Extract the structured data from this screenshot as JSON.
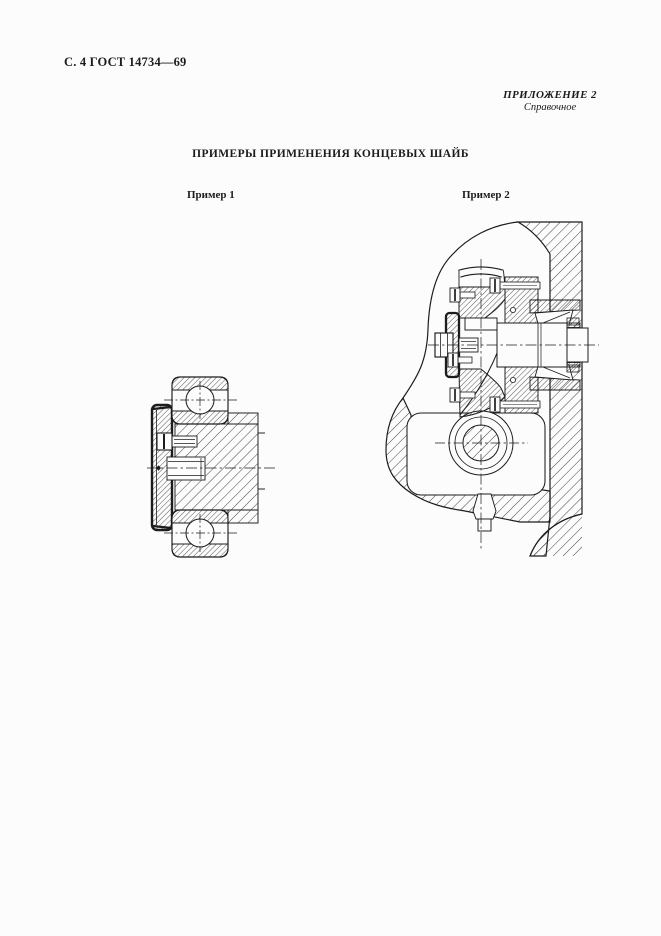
{
  "document": {
    "page_header": "С. 4 ГОСТ 14734—69",
    "annex": {
      "title": "ПРИЛОЖЕНИЕ 2",
      "subtitle": "Справочное"
    },
    "section_title": "ПРИМЕРЫ ПРИМЕНЕНИЯ КОНЦЕВЫХ ШАЙБ",
    "examples": [
      {
        "label": "Пример 1"
      },
      {
        "label": "Пример 2"
      }
    ]
  },
  "figures": {
    "example1_type": "cross-section-drawing",
    "example2_type": "cross-section-drawing"
  },
  "colors": {
    "paper": "#fcfcfc",
    "ink": "#1c1c1c"
  }
}
